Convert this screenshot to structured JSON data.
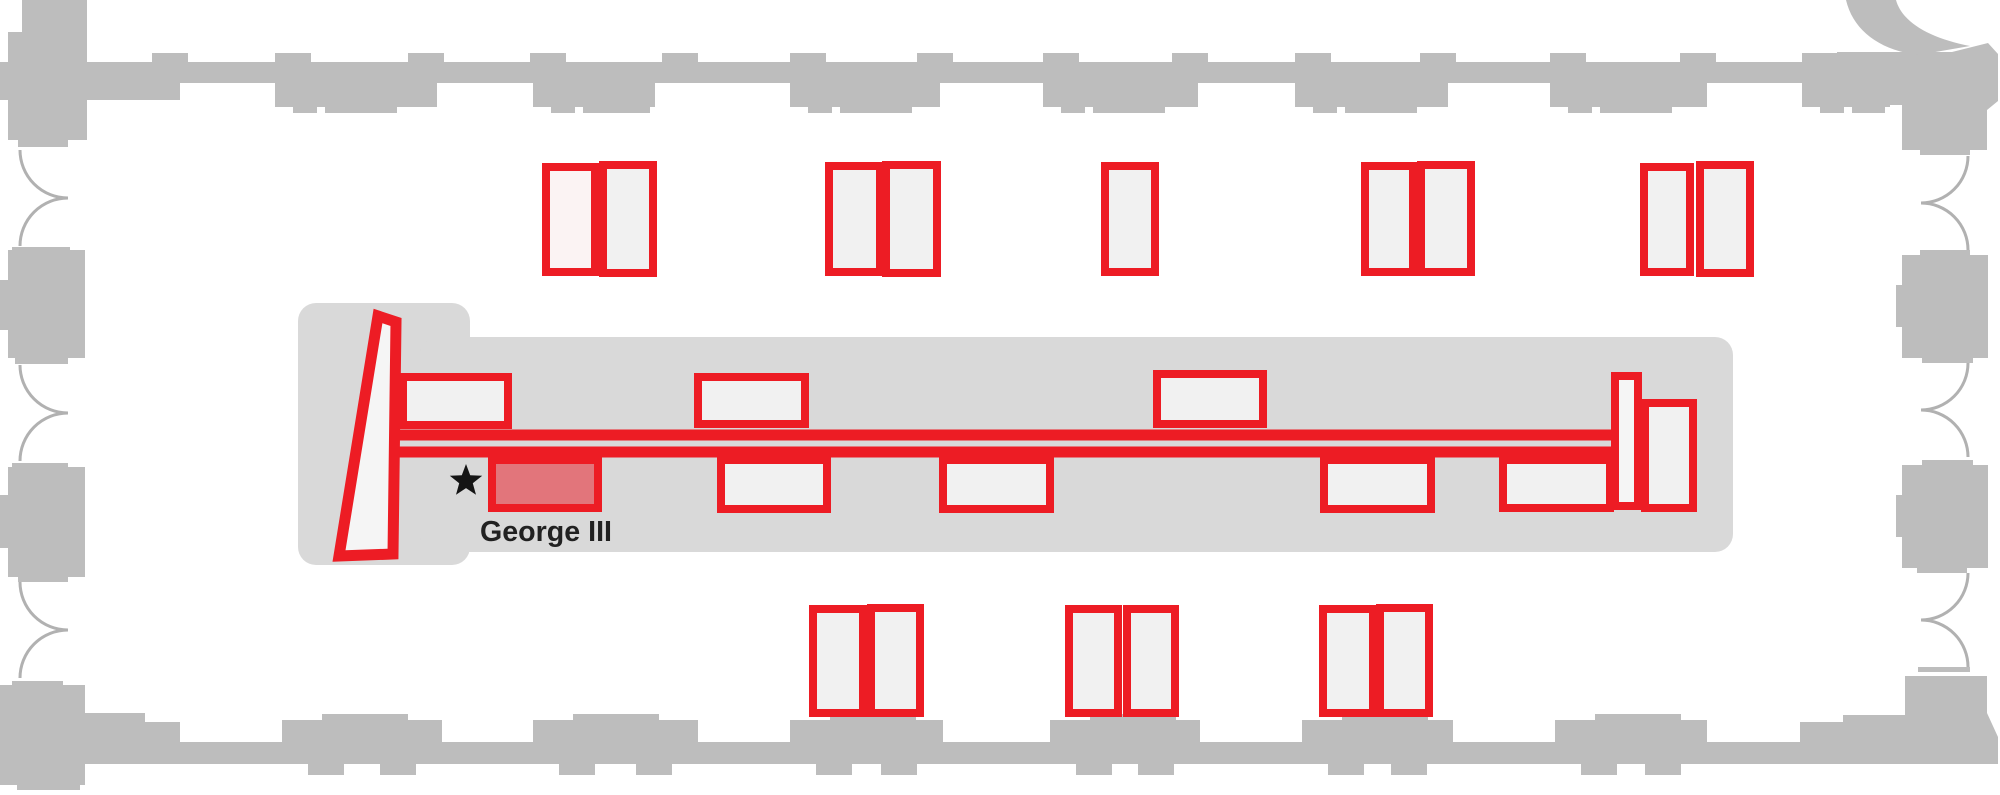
{
  "colors": {
    "background": "#ffffff",
    "wall": "#bdbdbd",
    "wall_arc": "#b1b1b1",
    "room_floor": "#d9d9d9",
    "case_red": "#ed1c24",
    "case_fill": "#f1f1f1",
    "case_fill_tinted": "#fbf3f3",
    "case_fill_highlight": "#e2757b",
    "route_inner": "#f5f5f5",
    "marker_black": "#151515",
    "label_color": "#212121"
  },
  "marker": {
    "label": "George III",
    "star_x": 466,
    "star_y": 481,
    "star_size": 17,
    "label_x": 480,
    "label_y": 541,
    "font_size": 29,
    "label_length": 132
  },
  "route": {
    "stroke_width": 11,
    "upper_line": {
      "x1": 394,
      "y1": 435,
      "x2": 1618,
      "y2": 435
    },
    "lower_line": {
      "x1": 397,
      "y1": 452,
      "x2": 1618,
      "y2": 452
    },
    "entry_wedge": {
      "points": [
        [
          378,
          316
        ],
        [
          396,
          322
        ],
        [
          393,
          554
        ],
        [
          339,
          556
        ]
      ]
    },
    "turn_bar": {
      "x": 1615,
      "y": 376,
      "w": 23,
      "h": 130
    }
  },
  "cases": {
    "border_width": 8,
    "top_row": [
      {
        "x": 546,
        "y": 167,
        "w": 49,
        "h": 105,
        "variant": "tinted"
      },
      {
        "x": 603,
        "y": 165,
        "w": 50,
        "h": 108,
        "variant": "plain"
      },
      {
        "x": 829,
        "y": 166,
        "w": 51,
        "h": 106,
        "variant": "plain"
      },
      {
        "x": 886,
        "y": 165,
        "w": 51,
        "h": 108,
        "variant": "plain"
      },
      {
        "x": 1105,
        "y": 166,
        "w": 50,
        "h": 106,
        "variant": "plain"
      },
      {
        "x": 1365,
        "y": 166,
        "w": 48,
        "h": 106,
        "variant": "plain"
      },
      {
        "x": 1421,
        "y": 165,
        "w": 50,
        "h": 107,
        "variant": "plain"
      },
      {
        "x": 1644,
        "y": 167,
        "w": 46,
        "h": 105,
        "variant": "plain"
      },
      {
        "x": 1700,
        "y": 165,
        "w": 50,
        "h": 108,
        "variant": "plain"
      }
    ],
    "gallery_upper": [
      {
        "x": 403,
        "y": 377,
        "w": 105,
        "h": 48,
        "variant": "plain"
      },
      {
        "x": 698,
        "y": 377,
        "w": 107,
        "h": 47,
        "variant": "plain"
      },
      {
        "x": 1157,
        "y": 374,
        "w": 106,
        "h": 50,
        "variant": "plain"
      }
    ],
    "gallery_lower": [
      {
        "x": 492,
        "y": 460,
        "w": 106,
        "h": 48,
        "variant": "highlight"
      },
      {
        "x": 721,
        "y": 460,
        "w": 106,
        "h": 49,
        "variant": "plain"
      },
      {
        "x": 943,
        "y": 460,
        "w": 107,
        "h": 49,
        "variant": "plain"
      },
      {
        "x": 1324,
        "y": 460,
        "w": 107,
        "h": 49,
        "variant": "plain"
      },
      {
        "x": 1503,
        "y": 460,
        "w": 107,
        "h": 48,
        "variant": "plain"
      }
    ],
    "end_wall_case": [
      {
        "x": 1645,
        "y": 403,
        "w": 48,
        "h": 105,
        "variant": "plain"
      }
    ],
    "bottom_row": [
      {
        "x": 813,
        "y": 609,
        "w": 50,
        "h": 104,
        "variant": "plain"
      },
      {
        "x": 871,
        "y": 608,
        "w": 49,
        "h": 105,
        "variant": "plain"
      },
      {
        "x": 1069,
        "y": 609,
        "w": 49,
        "h": 104,
        "variant": "plain"
      },
      {
        "x": 1127,
        "y": 609,
        "w": 48,
        "h": 104,
        "variant": "plain"
      },
      {
        "x": 1323,
        "y": 609,
        "w": 50,
        "h": 104,
        "variant": "plain"
      },
      {
        "x": 1380,
        "y": 608,
        "w": 49,
        "h": 105,
        "variant": "plain"
      }
    ]
  }
}
